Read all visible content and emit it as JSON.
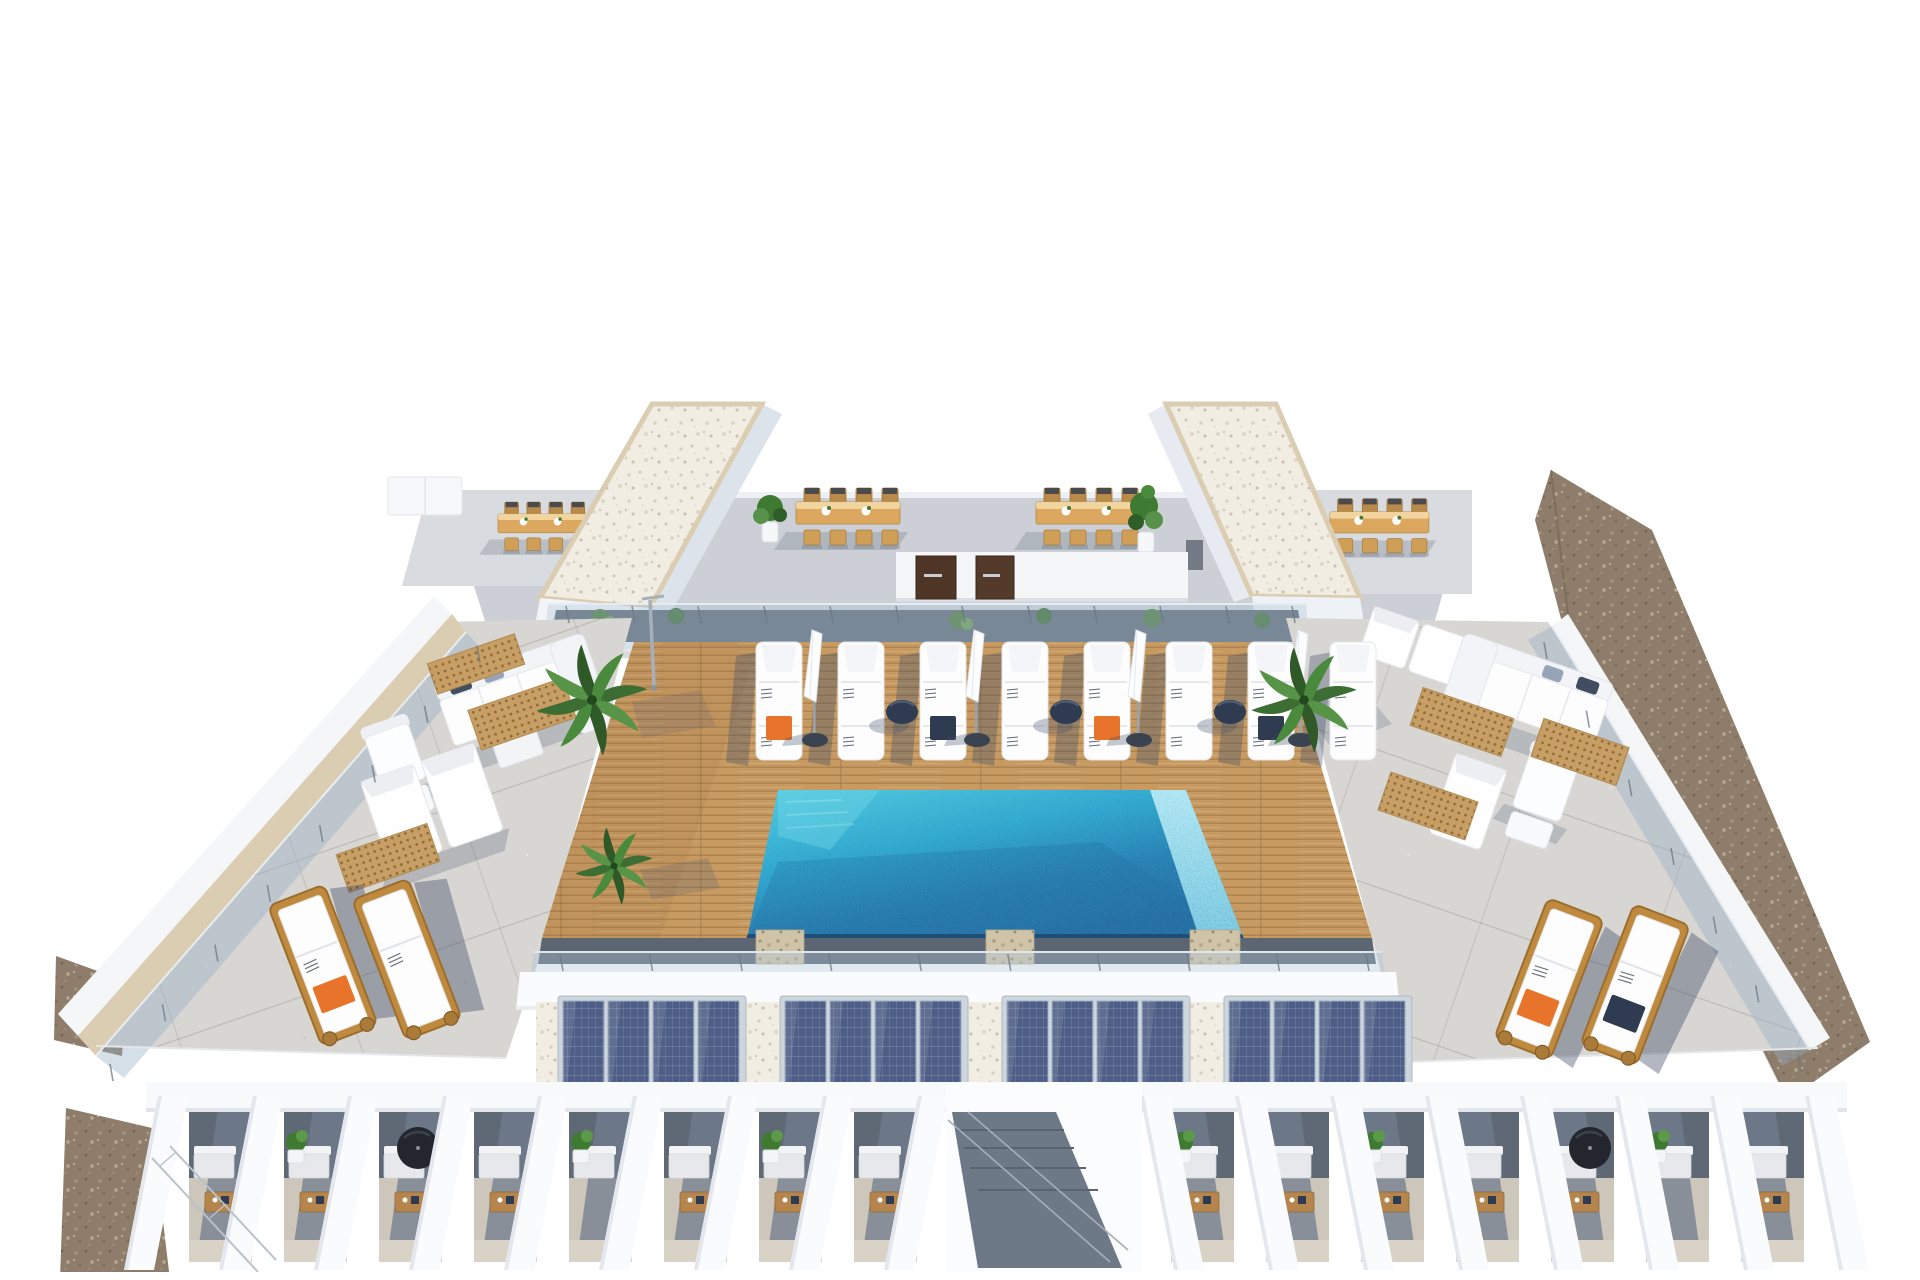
{
  "meta": {
    "type": "architectural-3d-render",
    "subject": "rooftop pool terrace aerial view"
  },
  "palette": {
    "page_bg": "#ffffff",
    "wall_light": "#f5f6f8",
    "wall_shade": "#dde3eb",
    "concrete": "#d7d6d2",
    "deck_wood": "#c79a62",
    "wood_table": "#dca75e",
    "wood_frame": "#c08a3e",
    "pool_light": "#4ac9df",
    "pool_mid": "#28a3cc",
    "pool_deep": "#1e6ba2",
    "pool_sparkle": "#9adfee",
    "navy": "#2e3b50",
    "orange": "#e8742c",
    "gravel_white": "#f1ede3",
    "gravel_brown": "#8d7d6a",
    "beige_trim": "#dacdb2",
    "plant_green": "#3f7a33",
    "solar_blue": "#4e5e86",
    "slate": "#5f6975",
    "terrace_floor": "#cdc6ba"
  },
  "scene": {
    "upper_terrace": {
      "dining_sets": 4,
      "chairs_per_set": 8,
      "doors": 2,
      "potted_plants": 2
    },
    "towers": {
      "count": 2,
      "roof_finish": "white-gravel"
    },
    "pool_deck": {
      "material": "timber",
      "loungers": {
        "count": 8,
        "towels": [
          "orange",
          "none",
          "navy",
          "none",
          "orange",
          "none",
          "navy",
          "none"
        ]
      },
      "umbrellas": {
        "count": 4,
        "state": "closed"
      },
      "side_tables": {
        "count": 3
      },
      "palms": 3
    },
    "pool": {
      "shape": "rectangular",
      "edge": "infinity-overflow-right"
    },
    "left_terrace": {
      "sofas": 2,
      "daybeds": 1,
      "deck_grates": 3,
      "loungers": {
        "count": 2,
        "towels": [
          "orange",
          "none"
        ]
      }
    },
    "right_terrace": {
      "sofas": 2,
      "daybeds": 2,
      "deck_grates": 3,
      "loungers": {
        "count": 2,
        "towels": [
          "orange",
          "navy"
        ]
      }
    },
    "solar": {
      "arrays": 4,
      "modules_per_array": 4
    },
    "pergola": {
      "left_beams": 9,
      "right_beams": 8,
      "left_units": [
        {
          "sofa": true,
          "table": true
        },
        {
          "plant": true,
          "sofa": true,
          "table": true
        },
        {
          "sofa": true,
          "table": true,
          "umbrella": true
        },
        {
          "sofa": true,
          "table": true
        },
        {
          "plant": true,
          "sofa": true
        },
        {
          "sofa": true,
          "table": true
        },
        {
          "plant": true,
          "sofa": true,
          "table": true
        },
        {
          "sofa": true,
          "table": true
        }
      ],
      "right_units": [
        {
          "plant": true,
          "sofa": true,
          "table": true
        },
        {
          "sofa": true,
          "table": true
        },
        {
          "plant": true,
          "sofa": true,
          "table": true
        },
        {
          "sofa": true,
          "table": true
        },
        {
          "sofa": true,
          "table": true,
          "umbrella": true
        },
        {
          "plant": true,
          "sofa": true
        },
        {
          "sofa": true,
          "table": true
        }
      ]
    },
    "railings": {
      "type": "glass",
      "locations": [
        "left-terrace-edge",
        "right-terrace-edge",
        "pool-deck-front",
        "upper-terrace-planter"
      ]
    }
  }
}
